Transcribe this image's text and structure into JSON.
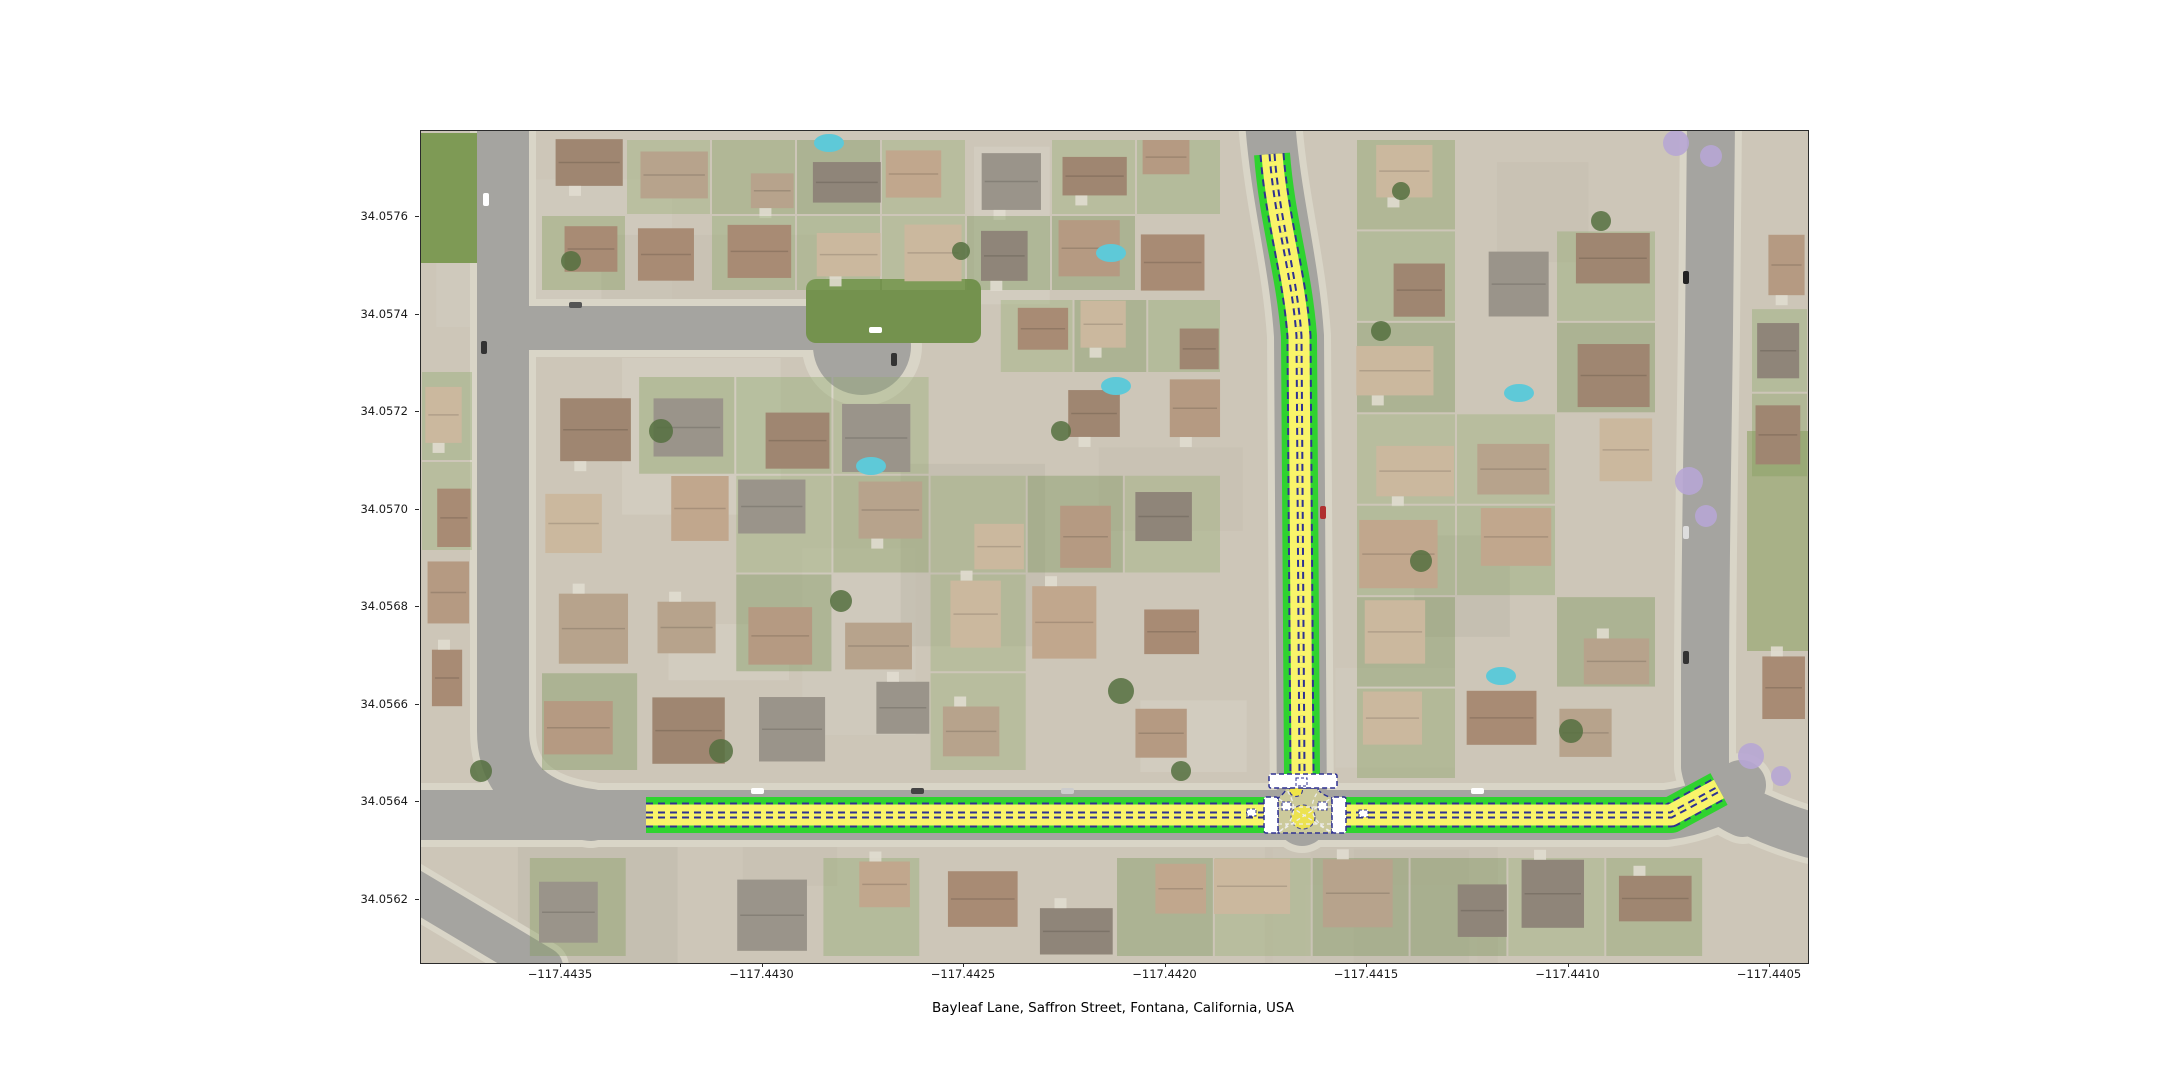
{
  "figure": {
    "title": "Bayleaf Lane, Saffron Street, Fontana, California, USA",
    "x_axis": {
      "ticks": [
        "−117.4435",
        "−117.4430",
        "−117.4425",
        "−117.4420",
        "−117.4415",
        "−117.4410",
        "−117.4405"
      ]
    },
    "y_axis": {
      "ticks": [
        "34.0576",
        "34.0574",
        "34.0572",
        "34.0570",
        "34.0568",
        "34.0566",
        "34.0564",
        "34.0562"
      ]
    }
  },
  "chart_data": {
    "type": "map",
    "map_type": "aerial imagery with lane-level street overlay",
    "title": "Bayleaf Lane, Saffron Street, Fontana, California, USA",
    "location": "Fontana, California, USA",
    "x_range": [
      -117.44385,
      -117.44041
    ],
    "y_range": [
      34.05607,
      34.05778
    ],
    "highlighted_streets": [
      {
        "name": "Bayleaf Lane",
        "orientation": "east-west",
        "lanes": 2
      },
      {
        "name": "Saffron Street",
        "orientation": "north-south",
        "lanes": 2
      }
    ],
    "junction": "T-intersection of Saffron Street into Bayleaf Lane",
    "crosswalk_count": 3,
    "junction_nodes": 2,
    "overlay_colors": {
      "casing_green": "#2fd32f",
      "lane_yellow": "#f9f46a",
      "lane_border_navy": "#2e3192",
      "crosswalk_white": "#ffffff",
      "intersection_fill": "rgba(252,248,150,0.45)",
      "junction_node_yellow": "#f5e93d"
    }
  }
}
